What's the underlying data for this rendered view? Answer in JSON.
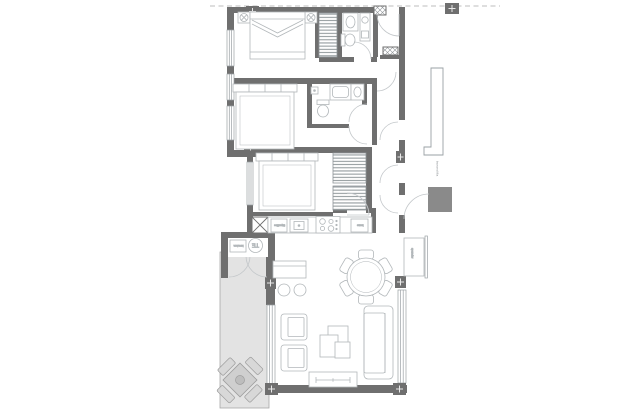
{
  "plan": {
    "type": "apartment-floor-plan",
    "labels": {
      "water_heater": "TE",
      "washer": "lavadora",
      "fridge": "frigorífico",
      "oven": "horno",
      "sideboard": "aparador",
      "railing": "barandilla"
    },
    "colors": {
      "wall": "#6f6f6f",
      "furniture_line": "#b2b7ba",
      "door_arc": "#c3c7ca",
      "terrace_fill": "#e3e3e3",
      "terrace_furniture": "#cfcfcf",
      "stripe": "#959c9f",
      "dashed_boundary": "#bcbcbc"
    }
  }
}
